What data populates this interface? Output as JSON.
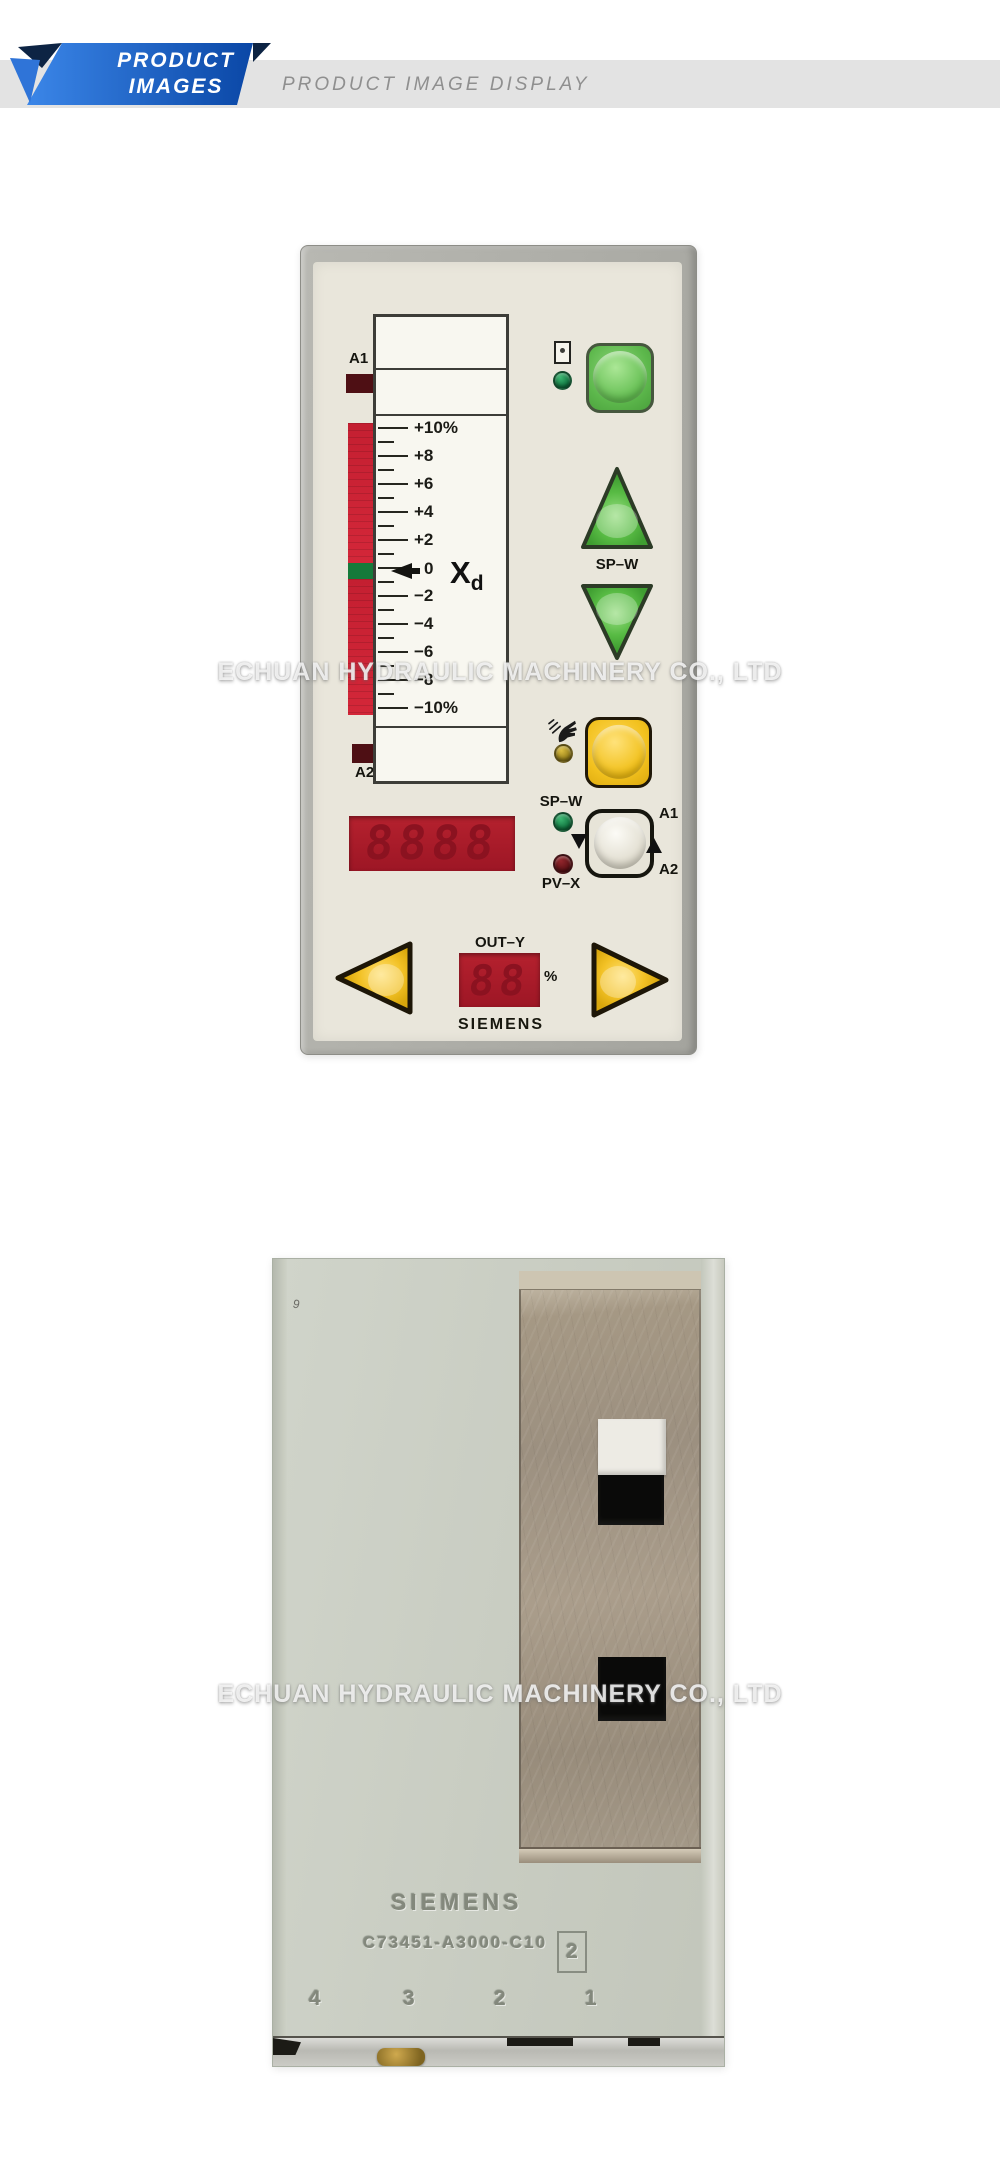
{
  "header": {
    "ribbon_line1": "PRODUCT",
    "ribbon_line2": "IMAGES",
    "bar_title": "PRODUCT IMAGE DISPLAY"
  },
  "watermark_text": "ECHUAN HYDRAULIC MACHINERY CO., LTD",
  "front_panel": {
    "a1_label": "A1",
    "a2_label": "A2",
    "xd_main": "X",
    "xd_sub": "d",
    "scale_labels": [
      "+10%",
      "+8",
      "+6",
      "+4",
      "+2",
      "0",
      "−2",
      "−4",
      "−6",
      "−8",
      "−10%"
    ],
    "sp_w_button_label": "SP–W",
    "sp_w_led_label": "SP–W",
    "pv_x_led_label": "PV–X",
    "toggle_a1_label": "A1",
    "toggle_a2_label": "A2",
    "main_display_value": "8888",
    "out_y_label": "OUT–Y",
    "out_y_value": "88",
    "out_y_unit": "%",
    "brand": "SIEMENS"
  },
  "rear_panel": {
    "brand": "SIEMENS",
    "part_number": "C73451-A3000-C10",
    "version_box": "2",
    "pins": [
      "4",
      "3",
      "2",
      "1"
    ]
  },
  "icons": {
    "manual_mode": "hand",
    "selector_cycle": "up-down-arrows"
  },
  "colors": {
    "ribbon_blue": "#1d63c8",
    "ribbon_fold_navy": "#0d2444",
    "header_bar_gray": "#e3e3e3",
    "panel_face": "#e9e6db",
    "button_green": "#5cb84e",
    "button_yellow": "#f2c11e",
    "display_red_bg": "#b2202c",
    "led_green": "#1f8a50",
    "led_yellow": "#b8932a",
    "led_red": "#6b1118",
    "bar_red": "#cc2433",
    "bar_green_segment": "#157a3a",
    "rear_case_gray": "#c9cec3",
    "rear_plate_tan": "#a0937f"
  }
}
